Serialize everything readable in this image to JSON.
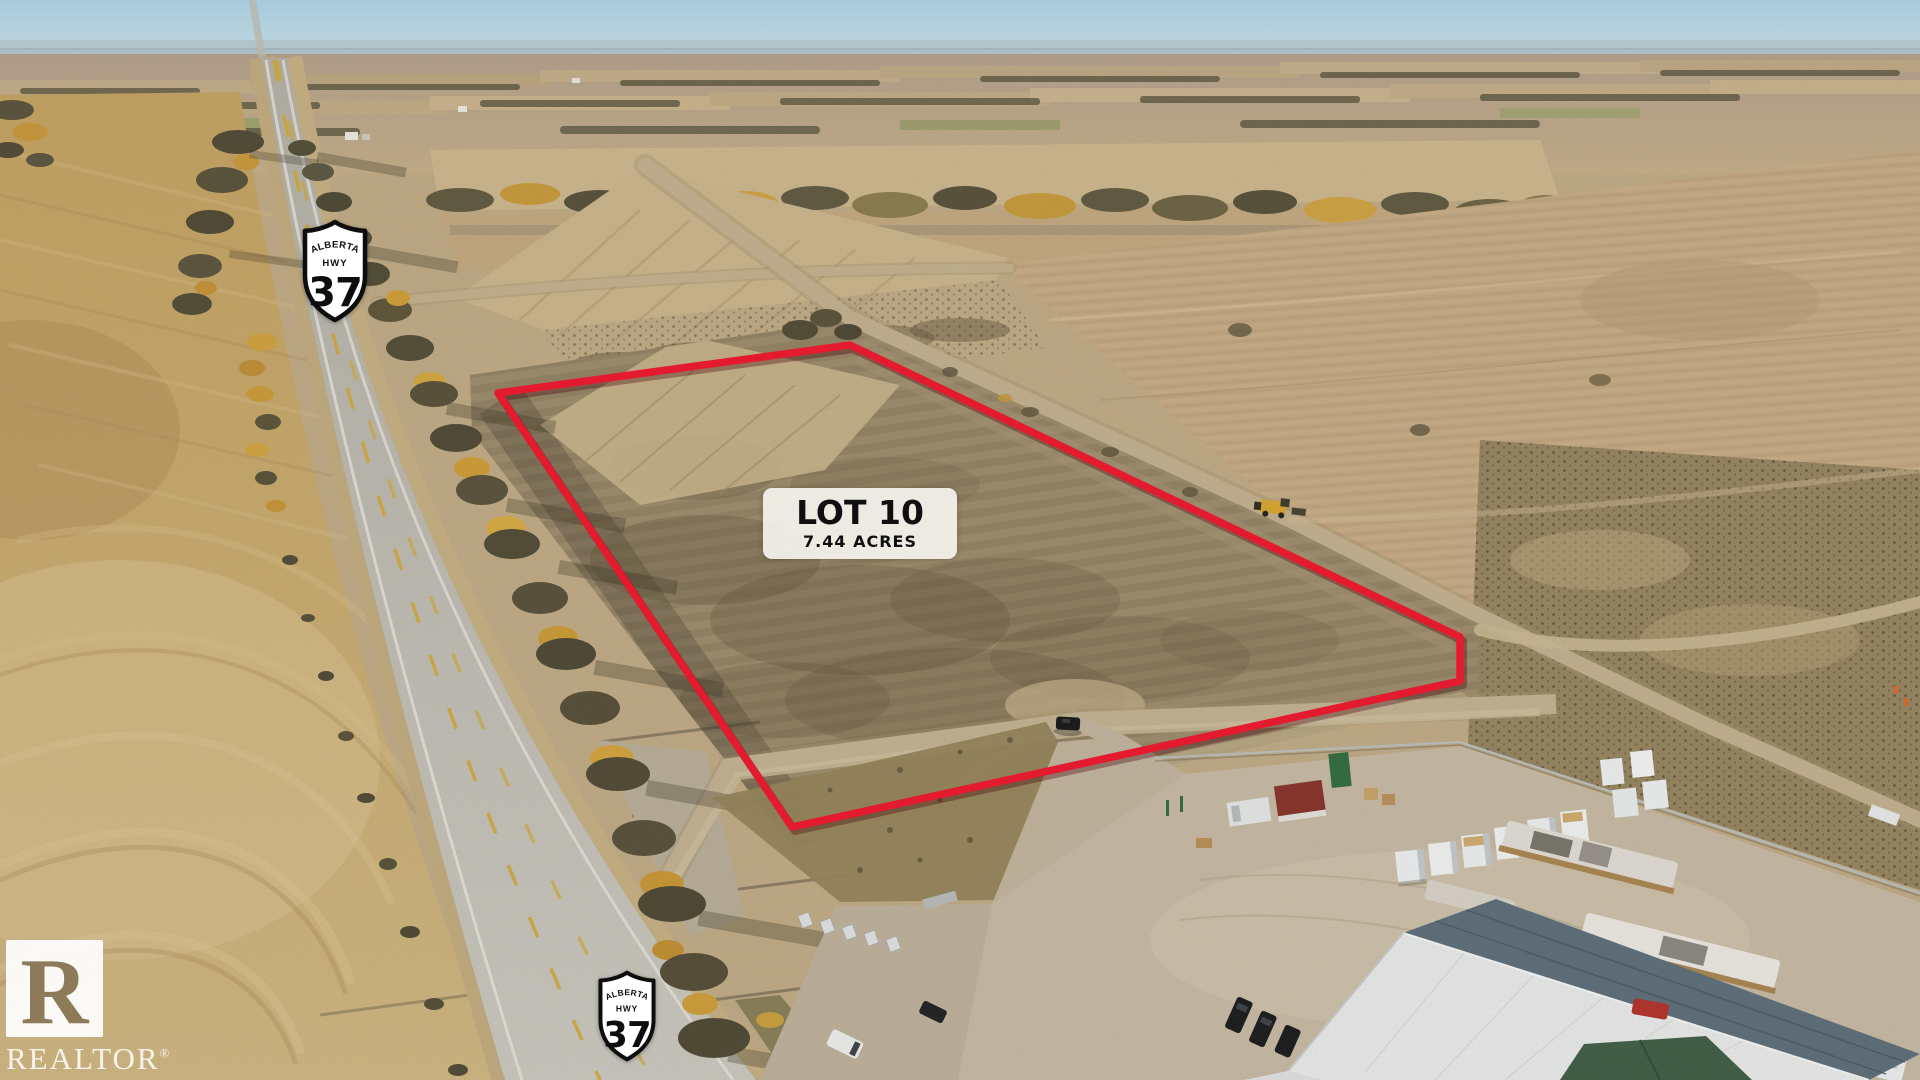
{
  "overlay": {
    "lot_label": {
      "title": "LOT 10",
      "subtitle": "7.44 ACRES"
    },
    "highway_shield": {
      "province": "ALBERTA",
      "road_type": "HWY",
      "number": "37"
    },
    "watermark": {
      "logo_letter": "R",
      "name": "REALTOR",
      "registered": "®"
    }
  },
  "colors": {
    "lot_boundary_red": "#e41b2e",
    "label_background": "rgba(247,246,241,0.9)",
    "label_text": "#0f0f0f",
    "shield_fill": "#ffffff",
    "shield_outline": "#0d0d0d",
    "shield_text": "#0d0d0d",
    "watermark_white": "#ffffff",
    "sky_blue": "#a7cadc",
    "asphalt_gray": "#bcbab2",
    "center_line_yellow": "#d2a93c",
    "field_gold": "#c9a968",
    "lot_soil_brown": "#97876a"
  }
}
